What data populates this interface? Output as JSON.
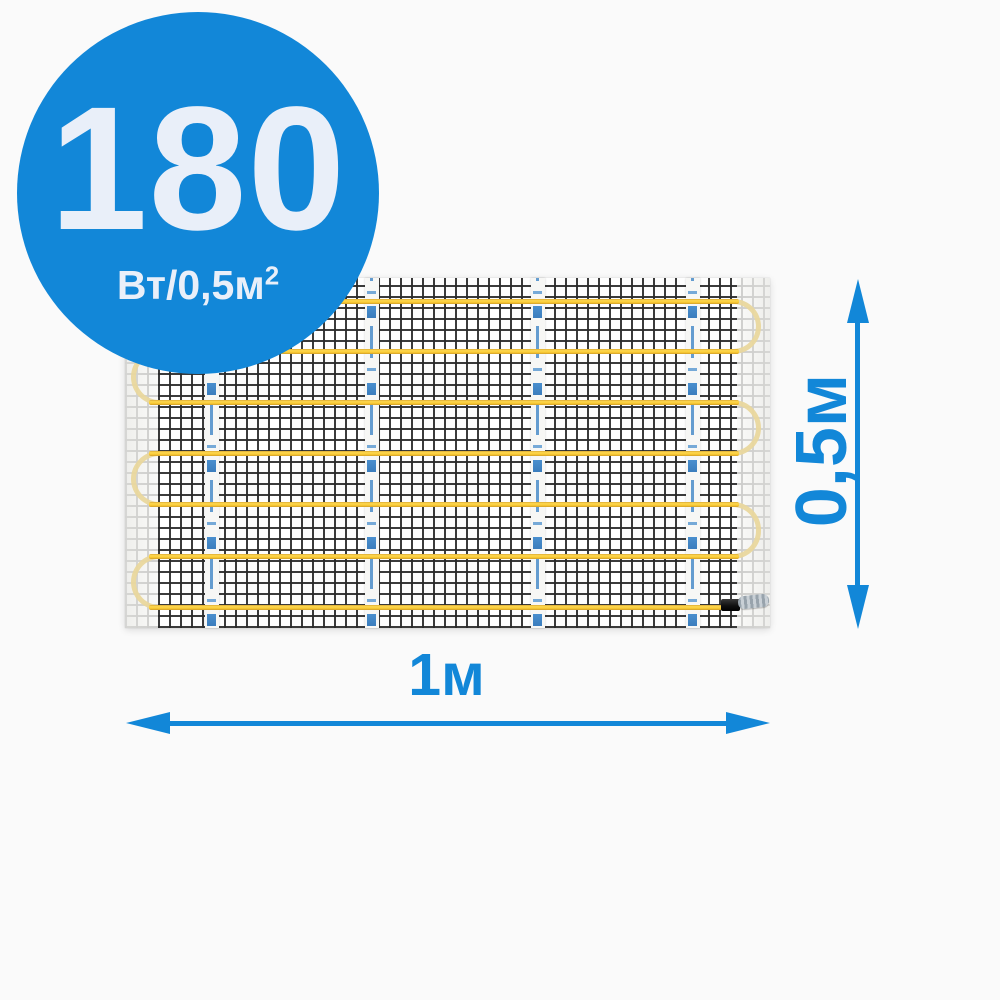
{
  "badge": {
    "value": "180",
    "unit": "Вт/0,5м",
    "unit_sup": "2"
  },
  "dimensions": {
    "height_label": "0,5м",
    "width_label": "1м"
  },
  "mat": {
    "cable_runs": 7,
    "cable_loops": 6,
    "brand_tapes": 4
  },
  "colors": {
    "accent_blue": "#1287d8",
    "badge_text": "#e9eff9",
    "cable_yellow": "#f8ca35",
    "cable_loop_pale": "#e9d79e",
    "mesh_black": "#2a2a2a",
    "tape_white": "#f7f7f5",
    "tape_mark_blue": "#4a8fce",
    "background": "#fafafa"
  }
}
